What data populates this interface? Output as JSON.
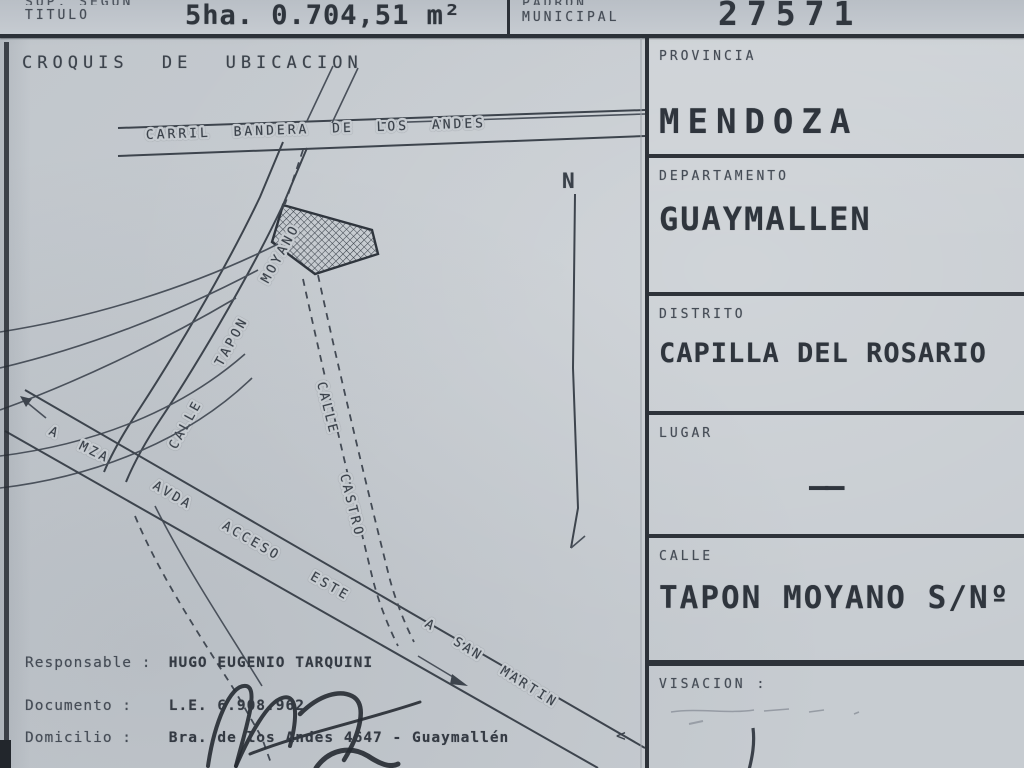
{
  "header": {
    "sup_label_top": "SUP. SEGUN",
    "sup_label": "TITULO",
    "sup_value": "5ha. 0.704,51 m²",
    "padron_label_top": "PADRON",
    "padron_label": "MUNICIPAL",
    "padron_value": "27571"
  },
  "croquis": {
    "title": "CROQUIS DE UBICACION",
    "north": "N",
    "labels": {
      "carril": "CARRIL BANDERA DE LOS ANDES",
      "tapon": "CALLE TAPON MOYANO",
      "castro": "CALLE CASTRO",
      "acceso": "AVDA ACCESO ESTE",
      "a_mza": "A MZA",
      "a_san_martin": "A SAN MARTIN"
    }
  },
  "fields": [
    {
      "label": "PROVINCIA",
      "value": "MENDOZA"
    },
    {
      "label": "DEPARTAMENTO",
      "value": "GUAYMALLEN"
    },
    {
      "label": "DISTRITO",
      "value": "CAPILLA DEL ROSARIO"
    },
    {
      "label": "LUGAR",
      "value": "——"
    },
    {
      "label": "CALLE",
      "value": "TAPON MOYANO S/Nº"
    },
    {
      "label": "VISACION :",
      "value": ""
    }
  ],
  "footer": {
    "responsable_label": "Responsable :",
    "responsable_value": "HUGO EUGENIO TARQUINI",
    "documento_label": "Documento :",
    "documento_value": "L.E. 6.908.962",
    "domicilio_label": "Domicilio :",
    "domicilio_value": "Bra. de los Andes 4647 - Guaymallén",
    "stray_mark": "<"
  },
  "colors": {
    "paper": "#c7ccd1",
    "ink": "#343a42"
  }
}
